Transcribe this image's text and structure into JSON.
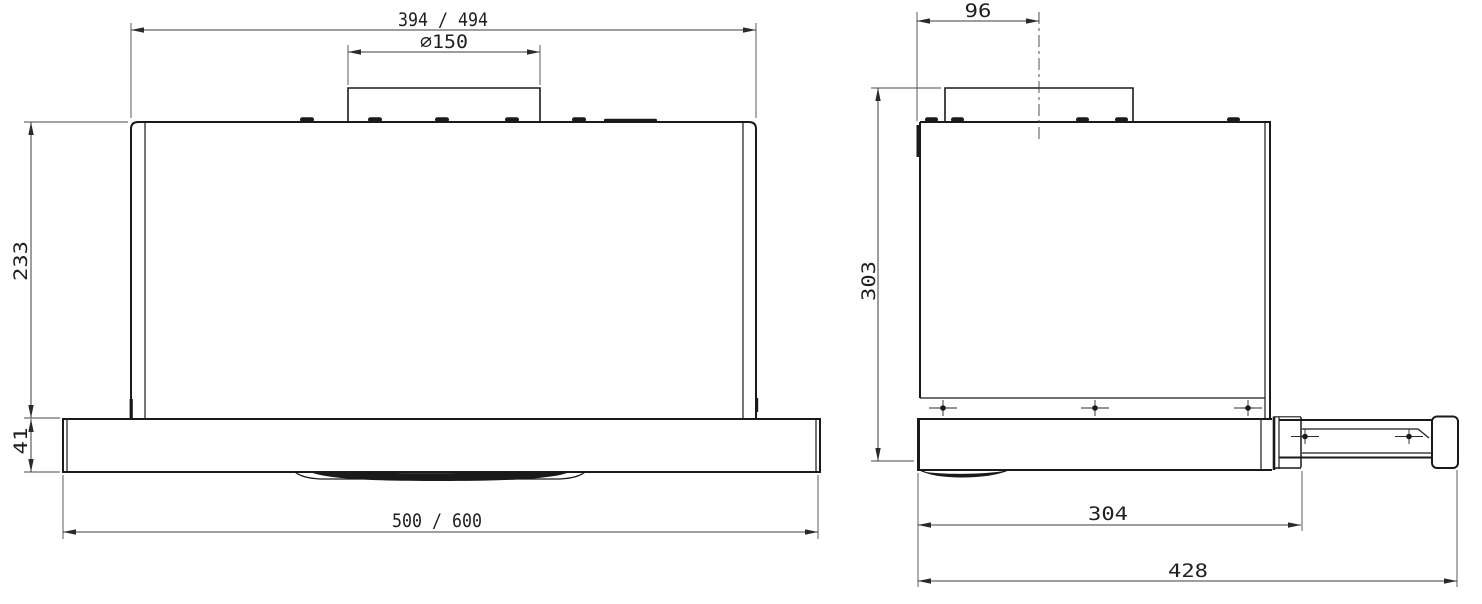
{
  "colors": {
    "background": "#ffffff",
    "object_line": "#1a1a1a",
    "dimension_line": "#3d3d3d",
    "text": "#1f1f1f"
  },
  "front_view": {
    "dims": {
      "top_width": "394 / 494",
      "duct_diameter": "⌀150",
      "body_height": "233",
      "visor_height": "41",
      "bottom_width": "500 / 600"
    }
  },
  "side_view": {
    "dims": {
      "duct_center_offset": "96",
      "total_height": "303",
      "body_depth": "304",
      "extended_depth": "428"
    }
  }
}
